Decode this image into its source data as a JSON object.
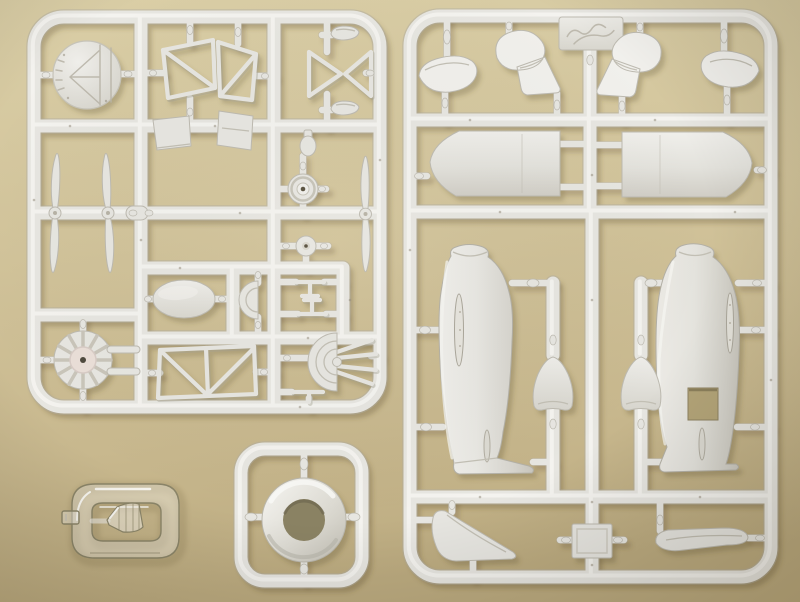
{
  "scene": {
    "type": "photograph",
    "subject": "Plastic scale-model aircraft kit sprues",
    "description": "Top-down photograph of an injection-moulded model aircraft kit on a tan background: two large white styrene part trees, a small clear sprue holding the cockpit canopy, and a square sprue holding the round engine cowling.",
    "colors": {
      "bg_top": "#d9cda6",
      "bg_mid": "#cfc096",
      "bg_dark": "#b7a77c",
      "cast": "#5f4f2c",
      "plastic": "#e7e6e1",
      "plastic_hi": "#f7f6f2",
      "plastic_edge": "#bdbab0",
      "cowl_hole": "#8a8263",
      "clear_edge": "#8a8468",
      "pin": "#8f8877",
      "cutout": "#b3a478",
      "engine_hub": "#eadfd8"
    },
    "sprues": [
      {
        "id": "left-sprue",
        "material": "white polystyrene",
        "position": "top left",
        "parts": [
          "engraved disc",
          "strut frame A",
          "strut frame B",
          "cross-brace struts",
          "cowl scoop half A",
          "cowl scoop half B",
          "two-blade propeller x3",
          "spinner pod x2",
          "bottle fitting",
          "main wheel",
          "small hub",
          "oval fuel tank",
          "half-round bulkhead",
          "cross brace x2",
          "radial engine",
          "truss side frame",
          "fan bulkhead with push rods",
          "axle bar",
          "cylindrical spacer"
        ]
      },
      {
        "id": "right-sprue",
        "material": "white polystyrene",
        "position": "right",
        "label_plate": "engraved script logo (illegible)",
        "parts": [
          "brand plate",
          "wheel-spat half x2",
          "spat-with-fairing half x2",
          "nacelle half x2",
          "fuselage half left",
          "fuselage half right with cockpit cut-out",
          "wheel fairing bell x2",
          "tail fin",
          "hatch panel",
          "blade fairing"
        ]
      },
      {
        "id": "cowling-sprue",
        "material": "white polystyrene",
        "position": "bottom centre",
        "parts": [
          "engine cowling ring"
        ]
      },
      {
        "id": "clear-sprue",
        "material": "clear polystyrene",
        "position": "bottom left",
        "parts": [
          "windscreen canopy",
          "clear tab"
        ]
      }
    ]
  }
}
